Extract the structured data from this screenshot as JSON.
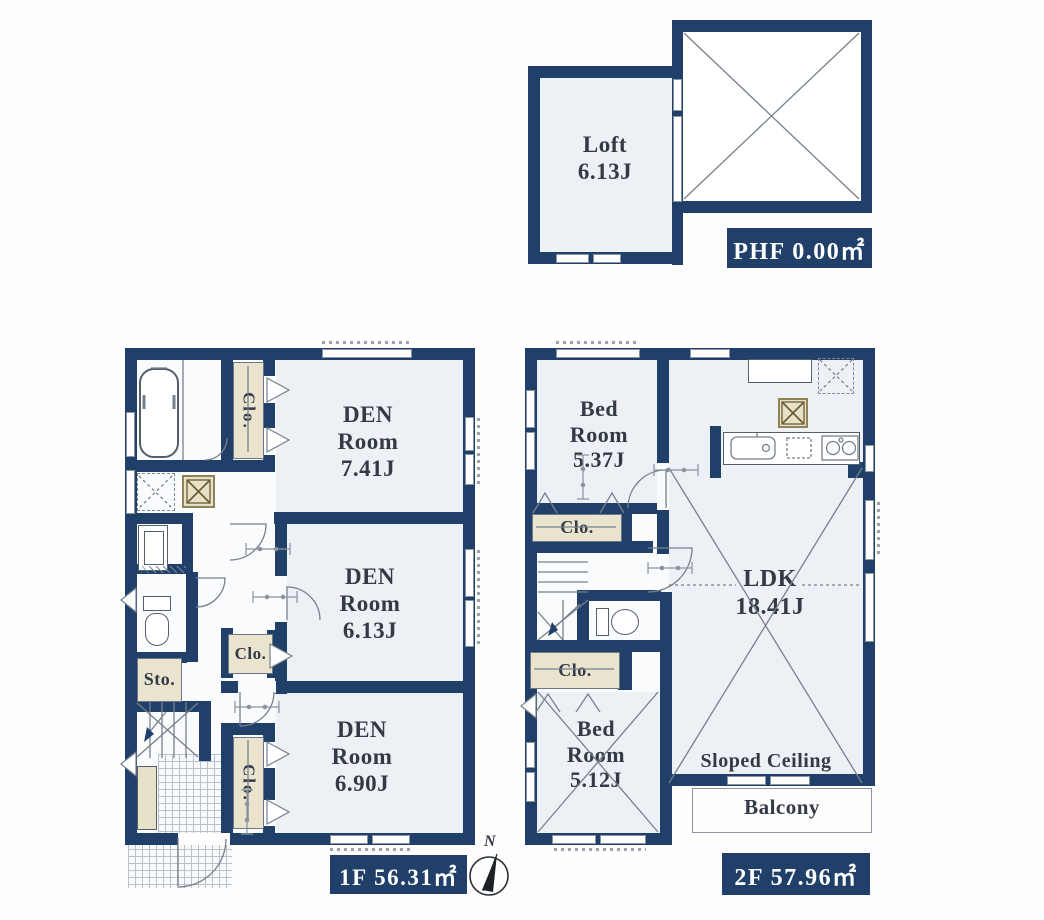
{
  "colors": {
    "wall_navy": "#20406a",
    "room_floor": "#edf1f5",
    "closet_cream": "#eae4cf",
    "line_grey": "#76808c",
    "label_grey": "#333a46"
  },
  "loft": {
    "name": "Loft",
    "area": "6.13J"
  },
  "phf": {
    "label": "PHF 0.00㎡"
  },
  "floor1": {
    "den1": {
      "l1": "DEN",
      "l2": "Room",
      "l3": "7.41J"
    },
    "den2": {
      "l1": "DEN",
      "l2": "Room",
      "l3": "6.13J"
    },
    "den3": {
      "l1": "DEN",
      "l2": "Room",
      "l3": "6.90J"
    },
    "clo1": "Clo.",
    "clo2": "Clo.",
    "clo3": "Clo.",
    "sto": "Sto.",
    "area_label": "1F 56.31㎡"
  },
  "floor2": {
    "bed1": {
      "l1": "Bed",
      "l2": "Room",
      "l3": "5.37J"
    },
    "bed2": {
      "l1": "Bed",
      "l2": "Room",
      "l3": "5.12J"
    },
    "ldk": {
      "l1": "LDK",
      "l2": "18.41J"
    },
    "clo1": "Clo.",
    "clo2": "Clo.",
    "sloped_ceiling": "Sloped Ceiling",
    "balcony": "Balcony",
    "area_label": "2F 57.96㎡"
  },
  "compass": {
    "north": "N"
  }
}
